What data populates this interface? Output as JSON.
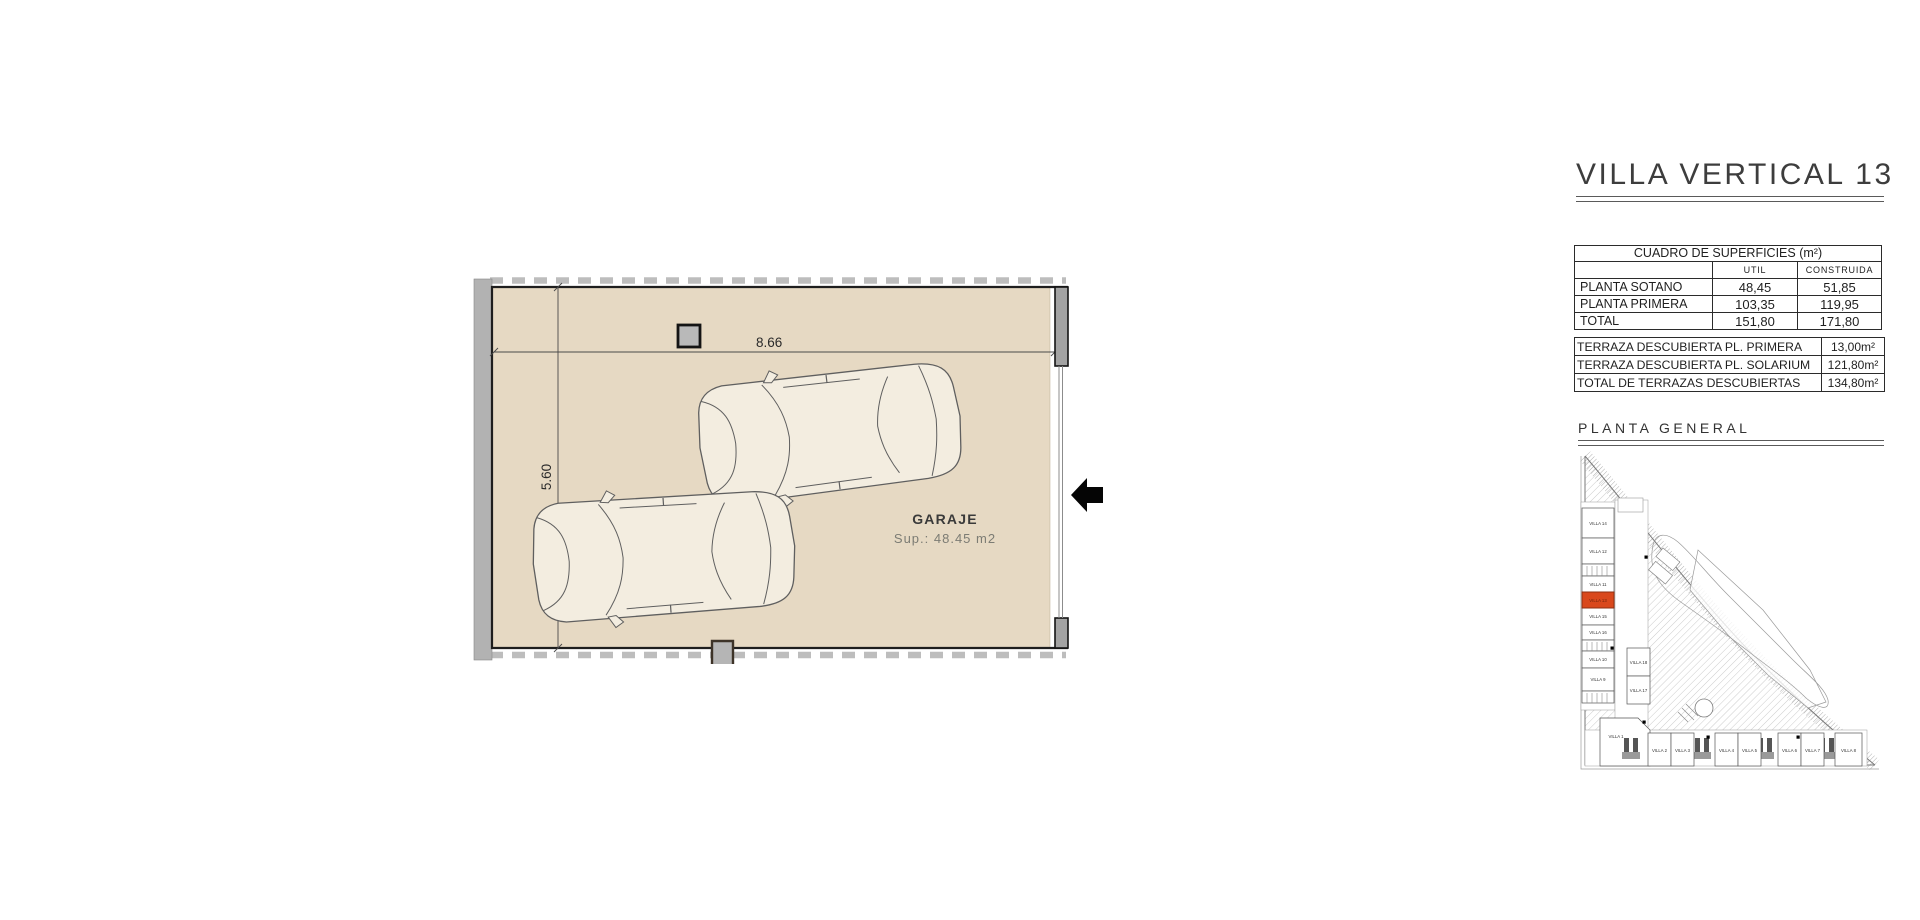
{
  "sheet": {
    "title": "VILLA VERTICAL 13"
  },
  "surfaces_table": {
    "title": "CUADRO DE SUPERFICIES (m²)",
    "col_headers": {
      "util": "UTIL",
      "construida": "CONSTRUIDA"
    },
    "rows": [
      {
        "label": "PLANTA SOTANO",
        "util": "48,45",
        "construida": "51,85"
      },
      {
        "label": "PLANTA PRIMERA",
        "util": "103,35",
        "construida": "119,95"
      },
      {
        "label": "TOTAL",
        "util": "151,80",
        "construida": "171,80"
      }
    ]
  },
  "terraces_table": {
    "rows": [
      {
        "label": "TERRAZA DESCUBIERTA PL. PRIMERA",
        "value": "13,00m²"
      },
      {
        "label": "TERRAZA DESCUBIERTA PL. SOLARIUM",
        "value": "121,80m²"
      },
      {
        "label": "TOTAL DE TERRAZAS DESCUBIERTAS",
        "value": "134,80m²"
      }
    ]
  },
  "floor_plan": {
    "room_label": "GARAJE",
    "room_area": "Sup.: 48.45 m2",
    "dim_width": "8.66",
    "dim_height": "5.60",
    "entrance_arrow_icon": "left-arrow"
  },
  "site_plan": {
    "title": "PLANTA  GENERAL",
    "highlighted_villa": "VILLA 13",
    "left_column_villas": [
      "VILLA 14",
      "VILLA 12",
      "VILLA 11",
      "VILLA 13",
      "VILLA 15",
      "VILLA 16",
      "VILLA 10",
      "VILLA 9"
    ],
    "middle_villas": [
      "VILLA 18",
      "VILLA 17"
    ],
    "bottom_row_villas": [
      "VILLA 1",
      "VILLA 2",
      "VILLA 3",
      "VILLA 4",
      "VILLA 5",
      "VILLA 6",
      "VILLA 7",
      "VILLA 8"
    ]
  },
  "colors": {
    "floor": "#e6d9c3",
    "wall": "#b2b2b2",
    "wall_dark": "#a3a3a3",
    "line": "#1e1e1e",
    "highlight": "#d9481c"
  }
}
